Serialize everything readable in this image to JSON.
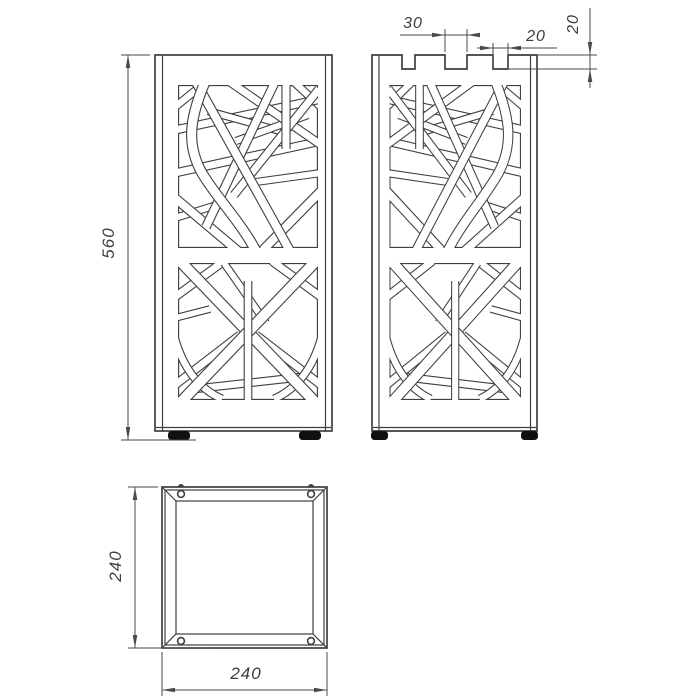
{
  "colors": {
    "background": "#ffffff",
    "line": "#3f3f3f",
    "dimension_line": "#4a4a4a",
    "text": "#3d3d3d",
    "feet": "#101010"
  },
  "dimension_labels": {
    "overall_height": "560",
    "top_slot_width_large": "30",
    "top_slot_width_small": "20",
    "top_slot_depth": "20",
    "base_depth": "240",
    "base_width": "240"
  }
}
